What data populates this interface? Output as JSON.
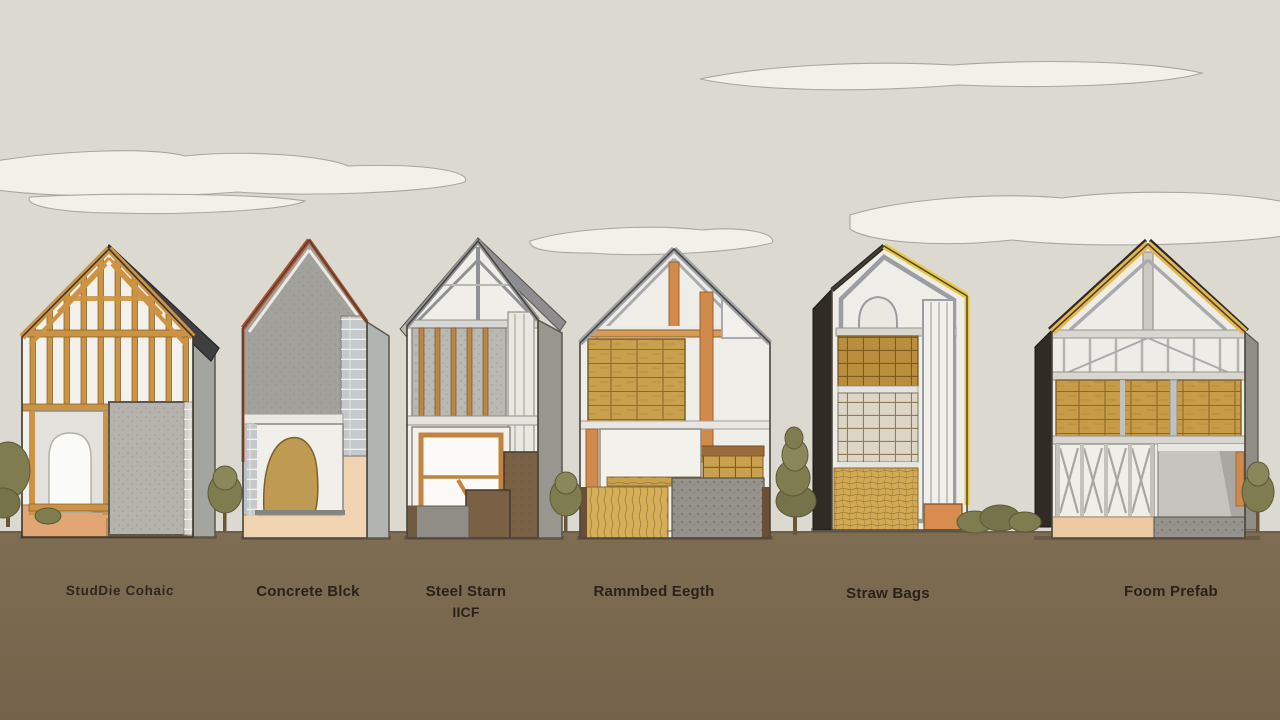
{
  "scene": {
    "description": "Illustrated comparison of six house construction cross-sections on a brown ground under a pale sky with clouds",
    "colors": {
      "sky": "#dcd9d1",
      "cloud_fill": "#f2f0e9",
      "cloud_outline": "#a9a69d",
      "ground": "#7a6a50",
      "label_text": "#29221a",
      "wood_frame": "#cd9344",
      "concrete_gray": "#a2a19c",
      "steel_gray": "#8f9194",
      "straw_tan": "#c9a04d",
      "earth_brown": "#7a6044",
      "roof_dark": "#3f3e40",
      "trim_red": "#b5502a",
      "trim_yellow": "#e9c83d",
      "trim_amber": "#e9b84b",
      "base_peach": "#ecc9a3",
      "tree_green": "#7f7c4f"
    }
  },
  "houses": [
    {
      "id": "stud-frame",
      "label": "StudDie Cohaic",
      "sublabel": ""
    },
    {
      "id": "concrete-block",
      "label": "Concrete Blck",
      "sublabel": ""
    },
    {
      "id": "steel-stam-icf",
      "label": "Steel Starn",
      "sublabel": "IICF"
    },
    {
      "id": "rammed-earth",
      "label": "Rammbed Eegth",
      "sublabel": ""
    },
    {
      "id": "straw-bags",
      "label": "Straw Bags",
      "sublabel": ""
    },
    {
      "id": "foam-prefab",
      "label": "Foom Prefab",
      "sublabel": ""
    }
  ]
}
